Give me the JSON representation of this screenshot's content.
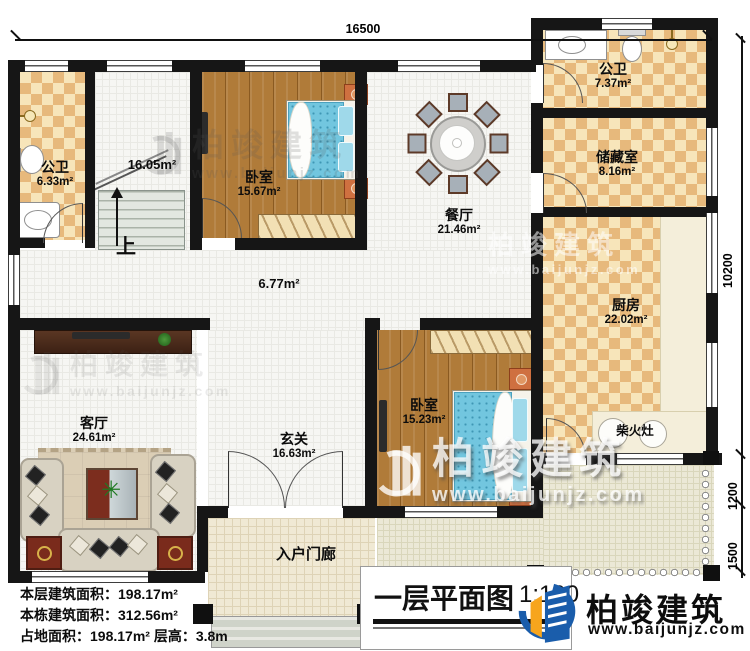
{
  "plan": {
    "title": "一层平面图",
    "scale": "1:100",
    "dimensions": {
      "top_width": "16500",
      "right_height": "10200",
      "right_seg1": "1200",
      "right_seg2": "1500"
    },
    "rooms": {
      "bath1": {
        "name": "公卫",
        "area": "6.33m²"
      },
      "stair_hall": {
        "area": "16.05m²",
        "up_label": "上"
      },
      "bedroom1": {
        "name": "卧室",
        "area": "15.67m²"
      },
      "dining": {
        "name": "餐厅",
        "area": "21.46m²"
      },
      "bath2": {
        "name": "公卫",
        "area": "7.37m²"
      },
      "storage": {
        "name": "储藏室",
        "area": "8.16m²"
      },
      "kitchen": {
        "name": "厨房",
        "area": "22.02m²"
      },
      "stove": {
        "name": "柴火灶"
      },
      "hallway": {
        "area": "6.77m²"
      },
      "living": {
        "name": "客厅",
        "area": "24.61m²"
      },
      "foyer": {
        "name": "玄关",
        "area": "16.63m²"
      },
      "bedroom2": {
        "name": "卧室",
        "area": "15.23m²"
      },
      "porch": {
        "name": "入户门廊"
      }
    },
    "stats": {
      "line1_label": "本层建筑面积：",
      "line1_value": "198.17m²",
      "line2_label": "本栋建筑面积：",
      "line2_value": "312.56m²",
      "line3_label": "占地面积：",
      "line3_value": "198.17m²",
      "line3b_label": "层高：",
      "line3b_value": "3.8m"
    },
    "brand": {
      "name": "柏竣建筑",
      "url": "www.baijunjz.com",
      "blue": "#1a5dab",
      "orange": "#f7a51d"
    }
  }
}
